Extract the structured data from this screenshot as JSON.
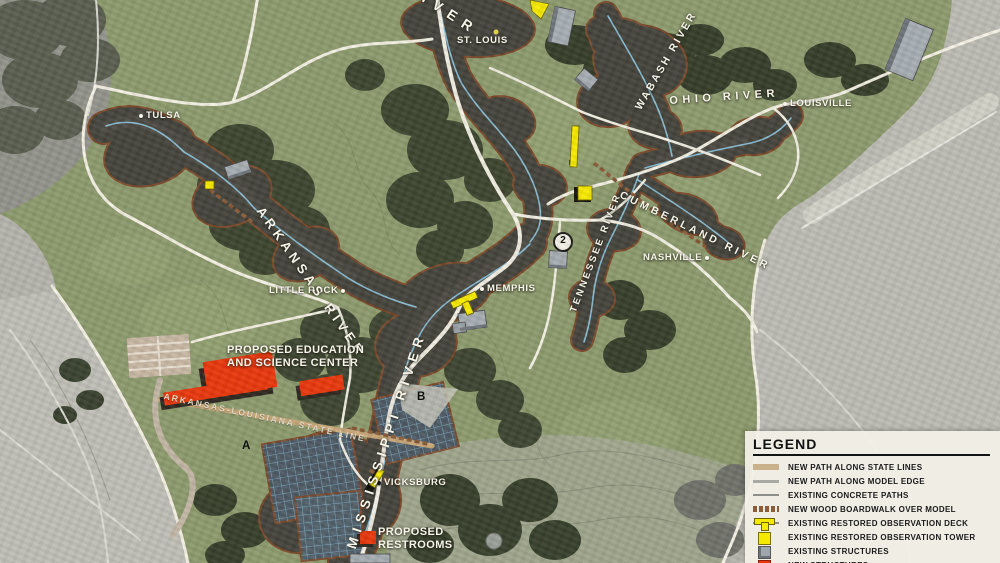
{
  "cities": {
    "tulsa": "TULSA",
    "st_louis": "ST. LOUIS",
    "little_rock": "LITTLE ROCK",
    "memphis": "MEMPHIS",
    "nashville": "NASHVILLE",
    "louisville": "LOUISVILLE",
    "vicksburg": "VICKSBURG"
  },
  "rivers": {
    "top_partial": "RIVER",
    "arkansas": "ARKANSAS RIVER",
    "mississippi": "MISSISSIPPI RIVER",
    "wabash": "WABASH RIVER",
    "ohio": "OHIO RIVER",
    "tennessee": "TENNESSEE RIVER",
    "cumberland": "CUMBERLAND RIVER",
    "state_line": "ARKANSAS-LOUISIANA STATE LINE"
  },
  "annotations": {
    "education_line1": "PROPOSED EDUCATION",
    "education_line2": "AND SCIENCE CENTER",
    "restrooms_line1": "PROPOSED",
    "restrooms_line2": "RESTROOMS"
  },
  "markers": {
    "a": "A",
    "b": "B",
    "circle2": "2"
  },
  "legend": {
    "title": "LEGEND",
    "items": [
      {
        "label": "NEW PATH ALONG STATE LINES",
        "swatch": "tan-path-line"
      },
      {
        "label": "NEW PATH ALONG MODEL EDGE",
        "swatch": "gray-path-line"
      },
      {
        "label": "EXISTING CONCRETE PATHS",
        "swatch": "concrete-path-line"
      },
      {
        "label": "NEW WOOD BOARDWALK OVER MODEL",
        "swatch": "wood-boardwalk-dashes"
      },
      {
        "label": "EXISTING RESTORED OBSERVATION DECK",
        "swatch": "yellow-deck-shape"
      },
      {
        "label": "EXISTING RESTORED OBSERVATION TOWER",
        "swatch": "yellow-square"
      },
      {
        "label": "EXISTING STRUCTURES",
        "swatch": "gray-square"
      },
      {
        "label": "NEW STRUCTURES",
        "swatch": "red-square"
      }
    ]
  },
  "colors": {
    "park_green": "#8d9a6d",
    "aerial_gray": "#bcbcb4",
    "path_white": "#f8f4e8",
    "state_line_tan": "#c9a87a",
    "boardwalk_brown": "#8a5c38",
    "observation_yellow": "#f6e900",
    "new_structure_red": "#e8380d",
    "existing_structure_gray": "#a6adb2",
    "model_dark": "#45443c",
    "model_edge_rust": "#7c4a2b",
    "water_blue": "#8cc3dc"
  }
}
